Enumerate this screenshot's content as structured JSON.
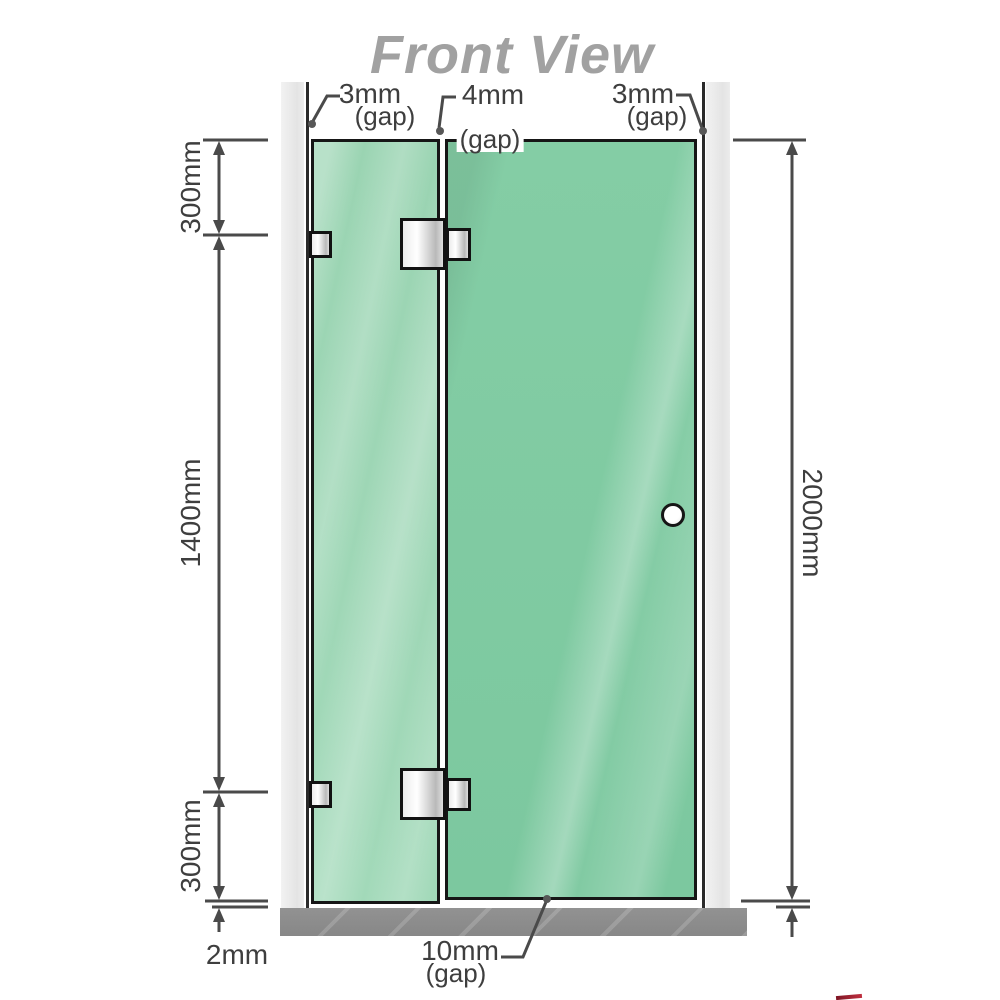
{
  "title": "Front View",
  "labels": {
    "top_left_gap": {
      "value": "3mm",
      "note": "(gap)"
    },
    "top_middle_gap": {
      "value": "4mm",
      "note": "(gap)"
    },
    "top_right_gap": {
      "value": "3mm",
      "note": "(gap)"
    },
    "bottom_door_gap": {
      "value": "10mm",
      "note": "(gap)"
    },
    "bottom_floor_gap": {
      "value": "2mm"
    }
  },
  "dimensions": {
    "left_top_segment": "300mm",
    "left_middle_segment": "1400mm",
    "left_bottom_segment": "300mm",
    "overall_height": "2000mm"
  },
  "colors": {
    "glass_fixed_panel": "#9ed6b6",
    "glass_door": "#81cba2",
    "wall_channel": "#e9e9e9",
    "floor": "#8d8d8d",
    "outline": "#161616",
    "dimension_lines": "#4a4a4a",
    "title_text": "#a1a1a1",
    "logo_artifact_red": "#8e1b2c"
  }
}
